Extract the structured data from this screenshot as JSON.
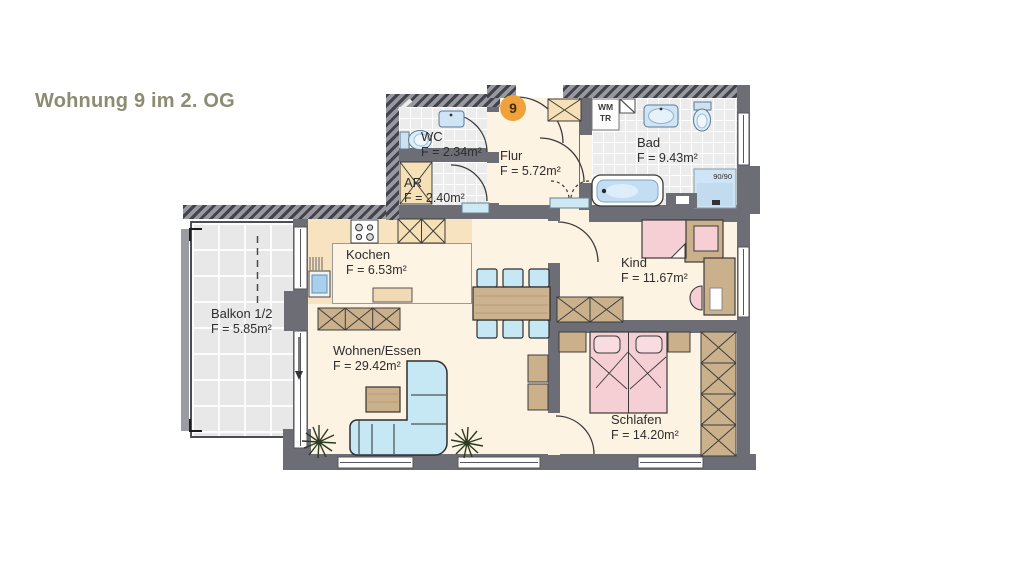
{
  "title": "Wohnung 9 im 2. OG",
  "unit_badge": "9",
  "rooms": {
    "wc": {
      "name": "WC",
      "area": "F = 2.34m²"
    },
    "ar": {
      "name": "AR",
      "area": "F = 2.40m²"
    },
    "flur": {
      "name": "Flur",
      "area": "F = 5.72m²"
    },
    "bad": {
      "name": "Bad",
      "area": "F = 9.43m²"
    },
    "kochen": {
      "name": "Kochen",
      "area": "F = 6.53m²"
    },
    "balkon": {
      "name": "Balkon 1/2",
      "area": "F = 5.85m²"
    },
    "wohnen": {
      "name": "Wohnen/Essen",
      "area": "F = 29.42m²"
    },
    "kind": {
      "name": "Kind",
      "area": "F = 11.67m²"
    },
    "schlafen": {
      "name": "Schlafen",
      "area": "F = 14.20m²"
    }
  },
  "labels": {
    "wm": "WM",
    "tr": "TR",
    "shower_size": "90/90"
  },
  "colors": {
    "title_text": "#8c8c72",
    "badge_orange": "#f0a139",
    "wall_gray": "#6d6d75",
    "floor_cream": "#fdf3e2",
    "kitchen_band": "#f8e3c0",
    "furniture_wood": "#cbb08c",
    "cabinet_tan": "#f6e0b6",
    "bed_pink": "#f5cfd4",
    "sofa_blue": "#c6e7f4"
  }
}
